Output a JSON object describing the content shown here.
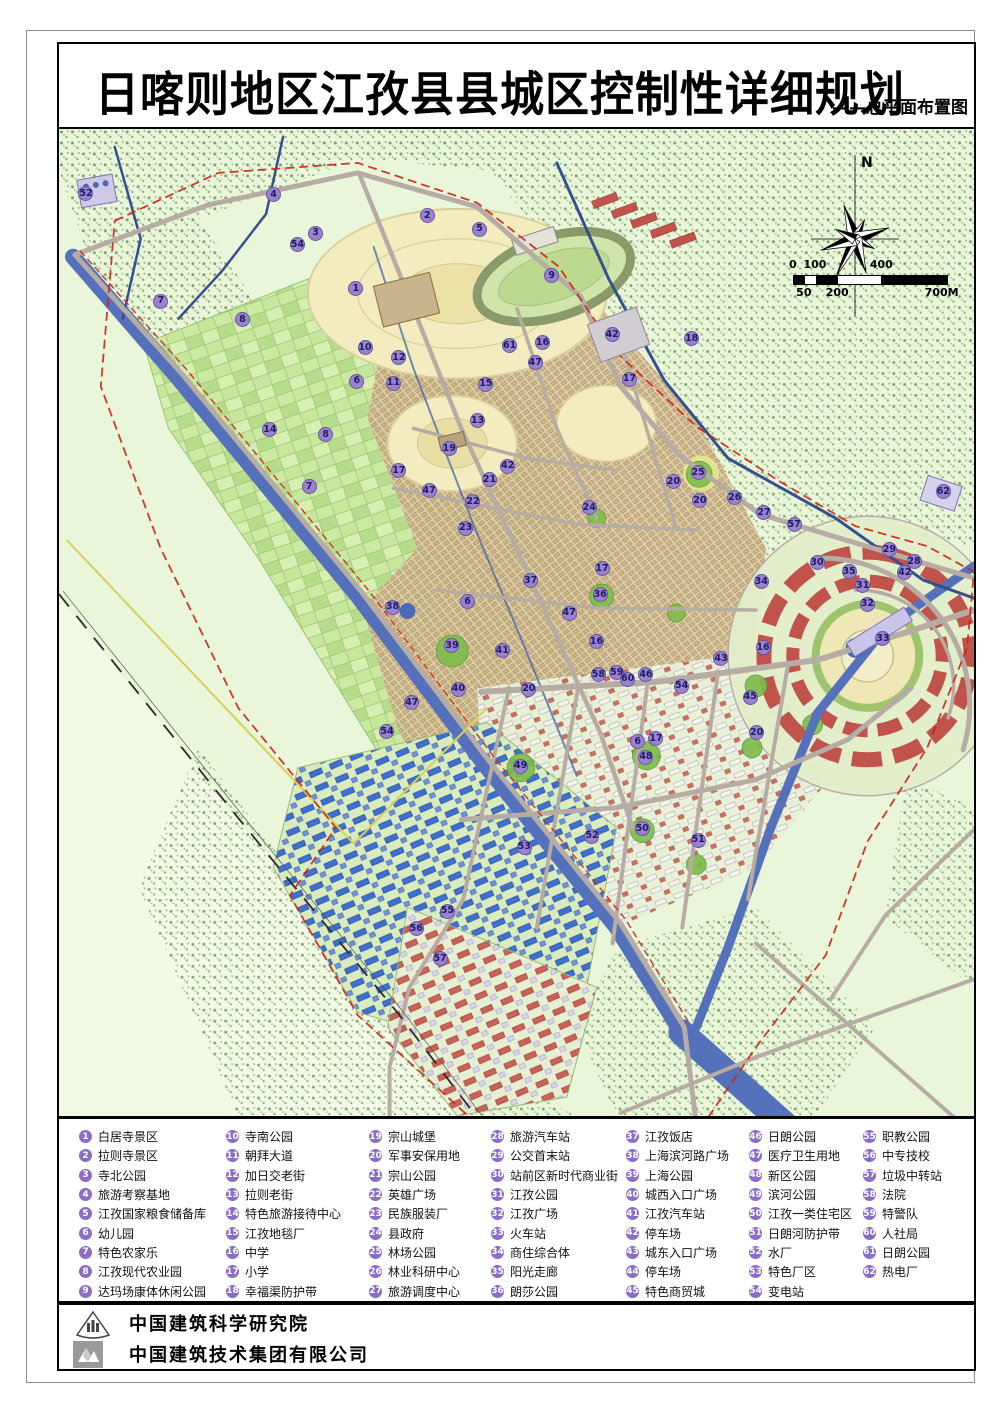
{
  "title": {
    "main": "日喀则地区江孜县县城区控制性详细规划",
    "subtitle": "——总平面布置图"
  },
  "map": {
    "north_label": "N",
    "scale_bar": {
      "top_labels": [
        {
          "text": "0",
          "pos": 0
        },
        {
          "text": "100",
          "pos": 14.3
        },
        {
          "text": "400",
          "pos": 57.1
        }
      ],
      "bottom_labels": [
        {
          "text": "50",
          "pos": 7.1
        },
        {
          "text": "200",
          "pos": 28.6
        },
        {
          "text": "700M",
          "pos": 96
        }
      ],
      "segments": [
        {
          "w": 7.14,
          "color": "#000000"
        },
        {
          "w": 7.14,
          "color": "#ffffff"
        },
        {
          "w": 14.29,
          "color": "#000000"
        },
        {
          "w": 28.57,
          "color": "#ffffff"
        },
        {
          "w": 42.86,
          "color": "#000000"
        }
      ]
    },
    "markers": [
      {
        "n": "52",
        "x": 3.0,
        "y": 6.6
      },
      {
        "n": "4",
        "x": 23.5,
        "y": 6.7
      },
      {
        "n": "2",
        "x": 40.3,
        "y": 8.8
      },
      {
        "n": "5",
        "x": 46.0,
        "y": 10.2
      },
      {
        "n": "3",
        "x": 28.1,
        "y": 10.6
      },
      {
        "n": "54",
        "x": 26.1,
        "y": 11.8
      },
      {
        "n": "9",
        "x": 53.9,
        "y": 14.9
      },
      {
        "n": "1",
        "x": 32.5,
        "y": 16.2
      },
      {
        "n": "7",
        "x": 11.2,
        "y": 17.5
      },
      {
        "n": "8",
        "x": 20.1,
        "y": 19.4
      },
      {
        "n": "42",
        "x": 60.5,
        "y": 20.9
      },
      {
        "n": "18",
        "x": 69.2,
        "y": 21.3
      },
      {
        "n": "16",
        "x": 52.9,
        "y": 21.7
      },
      {
        "n": "61",
        "x": 49.3,
        "y": 22.0
      },
      {
        "n": "10",
        "x": 33.5,
        "y": 22.2
      },
      {
        "n": "12",
        "x": 37.2,
        "y": 23.2
      },
      {
        "n": "47",
        "x": 52.1,
        "y": 23.7
      },
      {
        "n": "17",
        "x": 62.4,
        "y": 25.4
      },
      {
        "n": "6",
        "x": 32.6,
        "y": 25.6
      },
      {
        "n": "11",
        "x": 36.6,
        "y": 25.8
      },
      {
        "n": "15",
        "x": 46.7,
        "y": 25.9
      },
      {
        "n": "13",
        "x": 45.8,
        "y": 29.6
      },
      {
        "n": "14",
        "x": 23.1,
        "y": 30.5
      },
      {
        "n": "8",
        "x": 29.2,
        "y": 31.0
      },
      {
        "n": "19",
        "x": 42.7,
        "y": 32.4
      },
      {
        "n": "42",
        "x": 49.1,
        "y": 34.2
      },
      {
        "n": "17",
        "x": 37.2,
        "y": 34.7
      },
      {
        "n": "25",
        "x": 69.9,
        "y": 34.9
      },
      {
        "n": "21",
        "x": 47.1,
        "y": 35.6
      },
      {
        "n": "20",
        "x": 67.2,
        "y": 35.8
      },
      {
        "n": "7",
        "x": 27.4,
        "y": 36.3
      },
      {
        "n": "47",
        "x": 40.5,
        "y": 36.7
      },
      {
        "n": "62",
        "x": 96.7,
        "y": 36.8
      },
      {
        "n": "26",
        "x": 73.9,
        "y": 37.4
      },
      {
        "n": "20",
        "x": 70.1,
        "y": 37.7
      },
      {
        "n": "22",
        "x": 45.3,
        "y": 37.8
      },
      {
        "n": "24",
        "x": 58.0,
        "y": 38.4
      },
      {
        "n": "27",
        "x": 77.1,
        "y": 38.9
      },
      {
        "n": "57",
        "x": 80.4,
        "y": 40.1
      },
      {
        "n": "23",
        "x": 44.5,
        "y": 40.5
      },
      {
        "n": "29",
        "x": 90.8,
        "y": 42.7
      },
      {
        "n": "30",
        "x": 82.9,
        "y": 44.0
      },
      {
        "n": "28",
        "x": 93.5,
        "y": 43.9
      },
      {
        "n": "17",
        "x": 59.4,
        "y": 44.6
      },
      {
        "n": "35",
        "x": 86.4,
        "y": 44.9
      },
      {
        "n": "42",
        "x": 92.5,
        "y": 45.0
      },
      {
        "n": "37",
        "x": 51.6,
        "y": 45.8
      },
      {
        "n": "34",
        "x": 76.8,
        "y": 45.9
      },
      {
        "n": "31",
        "x": 87.9,
        "y": 46.3
      },
      {
        "n": "36",
        "x": 59.2,
        "y": 47.2
      },
      {
        "n": "6",
        "x": 44.7,
        "y": 47.9
      },
      {
        "n": "32",
        "x": 88.4,
        "y": 48.2
      },
      {
        "n": "38",
        "x": 36.5,
        "y": 48.5
      },
      {
        "n": "47",
        "x": 55.8,
        "y": 49.1
      },
      {
        "n": "33",
        "x": 90.1,
        "y": 51.7
      },
      {
        "n": "16",
        "x": 58.8,
        "y": 52.0
      },
      {
        "n": "39",
        "x": 43.0,
        "y": 52.4
      },
      {
        "n": "16",
        "x": 77.0,
        "y": 52.6
      },
      {
        "n": "41",
        "x": 48.5,
        "y": 52.9
      },
      {
        "n": "43",
        "x": 72.4,
        "y": 53.7
      },
      {
        "n": "59",
        "x": 61.0,
        "y": 55.1
      },
      {
        "n": "58",
        "x": 59.0,
        "y": 55.3
      },
      {
        "n": "46",
        "x": 64.2,
        "y": 55.3
      },
      {
        "n": "60",
        "x": 62.2,
        "y": 55.8
      },
      {
        "n": "54",
        "x": 68.1,
        "y": 56.5
      },
      {
        "n": "40",
        "x": 43.7,
        "y": 56.8
      },
      {
        "n": "20",
        "x": 51.4,
        "y": 56.8
      },
      {
        "n": "45",
        "x": 75.6,
        "y": 57.6
      },
      {
        "n": "47",
        "x": 38.6,
        "y": 58.2
      },
      {
        "n": "54",
        "x": 35.9,
        "y": 61.1
      },
      {
        "n": "20",
        "x": 76.3,
        "y": 61.2
      },
      {
        "n": "17",
        "x": 65.3,
        "y": 61.8
      },
      {
        "n": "6",
        "x": 63.3,
        "y": 62.1
      },
      {
        "n": "48",
        "x": 64.2,
        "y": 63.7
      },
      {
        "n": "49",
        "x": 50.5,
        "y": 64.6
      },
      {
        "n": "50",
        "x": 63.8,
        "y": 70.9
      },
      {
        "n": "52",
        "x": 58.3,
        "y": 71.7
      },
      {
        "n": "51",
        "x": 69.9,
        "y": 72.1
      },
      {
        "n": "53",
        "x": 50.9,
        "y": 72.8
      },
      {
        "n": "55",
        "x": 42.5,
        "y": 79.3
      },
      {
        "n": "56",
        "x": 39.1,
        "y": 81.1
      },
      {
        "n": "57",
        "x": 41.7,
        "y": 84.1
      }
    ]
  },
  "legend": {
    "items": [
      {
        "num": "1",
        "label": "白居寺景区"
      },
      {
        "num": "2",
        "label": "拉则寺景区"
      },
      {
        "num": "3",
        "label": "寺北公园"
      },
      {
        "num": "4",
        "label": "旅游考察基地"
      },
      {
        "num": "5",
        "label": "江孜国家粮食储备库"
      },
      {
        "num": "6",
        "label": "幼儿园"
      },
      {
        "num": "7",
        "label": "特色农家乐"
      },
      {
        "num": "8",
        "label": "江孜现代农业园"
      },
      {
        "num": "9",
        "label": "达玛场康体休闲公园"
      },
      {
        "num": "10",
        "label": "寺南公园"
      },
      {
        "num": "11",
        "label": "朝拜大道"
      },
      {
        "num": "12",
        "label": "加日交老街"
      },
      {
        "num": "13",
        "label": "拉则老街"
      },
      {
        "num": "14",
        "label": "特色旅游接待中心"
      },
      {
        "num": "15",
        "label": "江孜地毯厂"
      },
      {
        "num": "16",
        "label": "中学"
      },
      {
        "num": "17",
        "label": "小学"
      },
      {
        "num": "18",
        "label": "幸福渠防护带"
      },
      {
        "num": "19",
        "label": "宗山城堡"
      },
      {
        "num": "20",
        "label": "军事安保用地"
      },
      {
        "num": "21",
        "label": "宗山公园"
      },
      {
        "num": "22",
        "label": "英雄广场"
      },
      {
        "num": "23",
        "label": "民族服装厂"
      },
      {
        "num": "24",
        "label": "县政府"
      },
      {
        "num": "25",
        "label": "林场公园"
      },
      {
        "num": "26",
        "label": "林业科研中心"
      },
      {
        "num": "27",
        "label": "旅游调度中心"
      },
      {
        "num": "28",
        "label": "旅游汽车站"
      },
      {
        "num": "29",
        "label": "公交首末站"
      },
      {
        "num": "30",
        "label": "站前区新时代商业街"
      },
      {
        "num": "31",
        "label": "江孜公园"
      },
      {
        "num": "32",
        "label": "江孜广场"
      },
      {
        "num": "33",
        "label": "火车站"
      },
      {
        "num": "34",
        "label": "商住综合体"
      },
      {
        "num": "35",
        "label": "阳光走廊"
      },
      {
        "num": "36",
        "label": "朗莎公园"
      },
      {
        "num": "37",
        "label": "江孜饭店"
      },
      {
        "num": "38",
        "label": "上海滨河路广场"
      },
      {
        "num": "39",
        "label": "上海公园"
      },
      {
        "num": "40",
        "label": "城西入口广场"
      },
      {
        "num": "41",
        "label": "江孜汽车站"
      },
      {
        "num": "42",
        "label": "停车场"
      },
      {
        "num": "43",
        "label": "城东入口广场"
      },
      {
        "num": "44",
        "label": "停车场"
      },
      {
        "num": "45",
        "label": "特色商贸城"
      },
      {
        "num": "46",
        "label": "日朗公园"
      },
      {
        "num": "47",
        "label": "医疗卫生用地"
      },
      {
        "num": "48",
        "label": "新区公园"
      },
      {
        "num": "49",
        "label": "滨河公园"
      },
      {
        "num": "50",
        "label": "江孜一类住宅区"
      },
      {
        "num": "51",
        "label": "日朗河防护带"
      },
      {
        "num": "52",
        "label": "水厂"
      },
      {
        "num": "53",
        "label": "特色厂区"
      },
      {
        "num": "54",
        "label": "变电站"
      },
      {
        "num": "55",
        "label": "职教公园"
      },
      {
        "num": "56",
        "label": "中专技校"
      },
      {
        "num": "57",
        "label": "垃圾中转站"
      },
      {
        "num": "58",
        "label": "法院"
      },
      {
        "num": "59",
        "label": "特警队"
      },
      {
        "num": "60",
        "label": "人社局"
      },
      {
        "num": "61",
        "label": "日朗公园"
      },
      {
        "num": "62",
        "label": "热电厂"
      }
    ]
  },
  "footer": {
    "org1": "中国建筑科学研究院",
    "org2": "中国建筑技术集团有限公司"
  },
  "colors": {
    "map_bg": "#eaf6d9",
    "river": "#5671bb",
    "marker_fill": "#9b82cf",
    "marker_text": "#1d1d66",
    "legend_circle": "#8d6cc8",
    "boundary_red": "#cc2418"
  }
}
